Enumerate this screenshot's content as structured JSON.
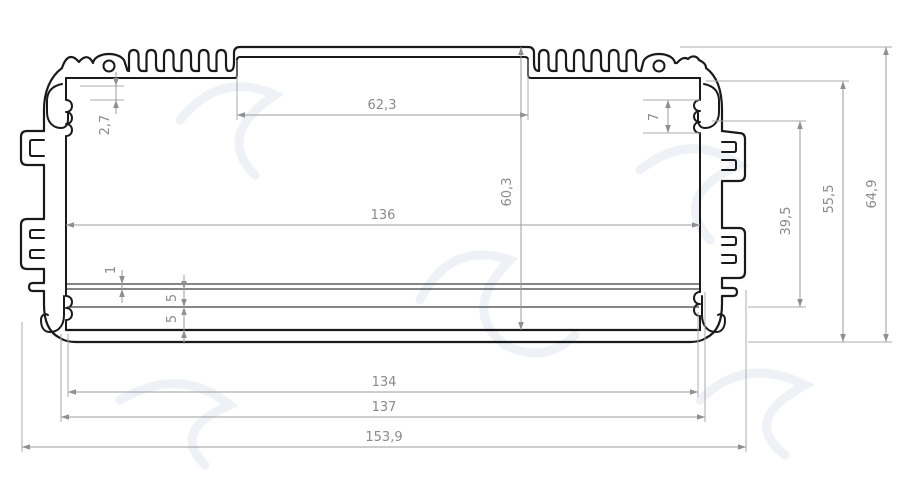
{
  "drawing": {
    "kind": "technical-cross-section",
    "subject": "finned aluminum extrusion enclosure profile",
    "units_style": "comma-decimal",
    "colors": {
      "outline": "#1a1a1a",
      "dimension_lines": "#9b9b9b",
      "dimension_text": "#8a8a8a",
      "background": "#ffffff",
      "watermark": "#e3eaf1"
    },
    "dimensions": [
      {
        "label": "62,3",
        "axis": "h",
        "x1": 237,
        "x2": 528,
        "y": 115,
        "tx": 382,
        "ty": 109,
        "arrows": "in"
      },
      {
        "label": "136",
        "axis": "h",
        "x1": 66,
        "x2": 700,
        "y": 225,
        "tx": 383,
        "ty": 219,
        "arrows": "in"
      },
      {
        "label": "134",
        "axis": "h",
        "x1": 68,
        "x2": 698,
        "y": 392,
        "tx": 384,
        "ty": 386,
        "arrows": "in"
      },
      {
        "label": "137",
        "axis": "h",
        "x1": 61,
        "x2": 705,
        "y": 417,
        "tx": 384,
        "ty": 411,
        "arrows": "in"
      },
      {
        "label": "153,9",
        "axis": "h",
        "x1": 22,
        "x2": 746,
        "y": 447,
        "tx": 384,
        "ty": 441,
        "arrows": "in"
      },
      {
        "label": "2,7",
        "axis": "v",
        "x": 116,
        "y1": 86,
        "y2": 100,
        "tx": 109,
        "ty": 125,
        "arrows": "out"
      },
      {
        "label": "7",
        "axis": "v",
        "x": 668,
        "y1": 100,
        "y2": 133,
        "tx": 658,
        "ty": 117,
        "arrows": "in"
      },
      {
        "label": "60,3",
        "axis": "v",
        "x": 521,
        "y1": 47,
        "y2": 330,
        "tx": 511,
        "ty": 192,
        "arrows": "in"
      },
      {
        "label": "39,5",
        "axis": "v",
        "x": 800,
        "y1": 121,
        "y2": 307,
        "tx": 790,
        "ty": 221,
        "arrows": "in"
      },
      {
        "label": "55,5",
        "axis": "v",
        "x": 843,
        "y1": 81,
        "y2": 342,
        "tx": 833,
        "ty": 199,
        "arrows": "in"
      },
      {
        "label": "64,9",
        "axis": "v",
        "x": 886,
        "y1": 47,
        "y2": 342,
        "tx": 876,
        "ty": 194,
        "arrows": "in"
      },
      {
        "label": "1",
        "axis": "v",
        "x": 122,
        "y1": 284,
        "y2": 289,
        "tx": 115,
        "ty": 270,
        "arrows": "out"
      },
      {
        "label": "5",
        "axis": "v",
        "x": 184,
        "y1": 289,
        "y2": 307,
        "tx": 176,
        "ty": 298,
        "arrows": "out"
      },
      {
        "label": "5",
        "axis": "v",
        "x": 184,
        "y1": 307,
        "y2": 330,
        "tx": 176,
        "ty": 319,
        "arrows": "out"
      }
    ]
  }
}
